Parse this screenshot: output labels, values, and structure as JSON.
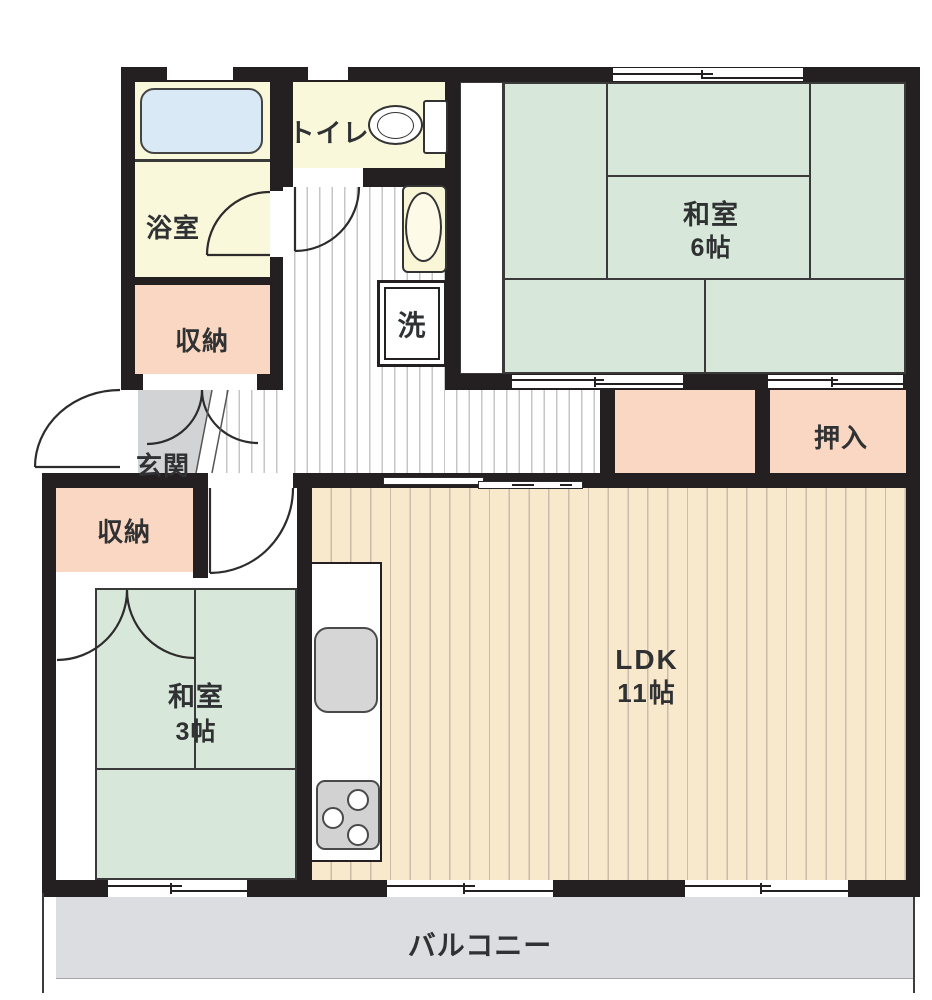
{
  "rooms": {
    "bathroom": {
      "label": "浴室"
    },
    "toilet": {
      "label": "トイレ"
    },
    "storage_upper": {
      "label": "収納"
    },
    "entrance": {
      "label": "玄関"
    },
    "japanese_room_6": {
      "label": "和室",
      "size": "6帖"
    },
    "oshiire": {
      "label": "押入"
    },
    "storage_lower": {
      "label": "収納"
    },
    "japanese_room_3": {
      "label": "和室",
      "size": "3帖"
    },
    "ldk": {
      "label": "LDK",
      "size": "11帖"
    },
    "laundry": {
      "label": "洗"
    },
    "balcony": {
      "label": "バルコニー"
    }
  },
  "fixtures": [
    "bathtub",
    "toilet-bowl",
    "toilet-tank",
    "washbasin",
    "washing-machine-pan",
    "kitchen-sink",
    "gas-stove"
  ],
  "colors": {
    "wall": "#241f20",
    "tatami": "#d7e8da",
    "wet": "#faf8da",
    "closet": "#f9d7c2",
    "ldk_floor": "#f9e9cc",
    "ldk_stripe": "#c9bcab",
    "tub": "#d9eaf6",
    "genkan": "#d2d3d5",
    "balcony": "#dcdde0",
    "hall_stripe": "#c6c6c6",
    "line": "#3a3a3a",
    "text": "#2f3133"
  }
}
